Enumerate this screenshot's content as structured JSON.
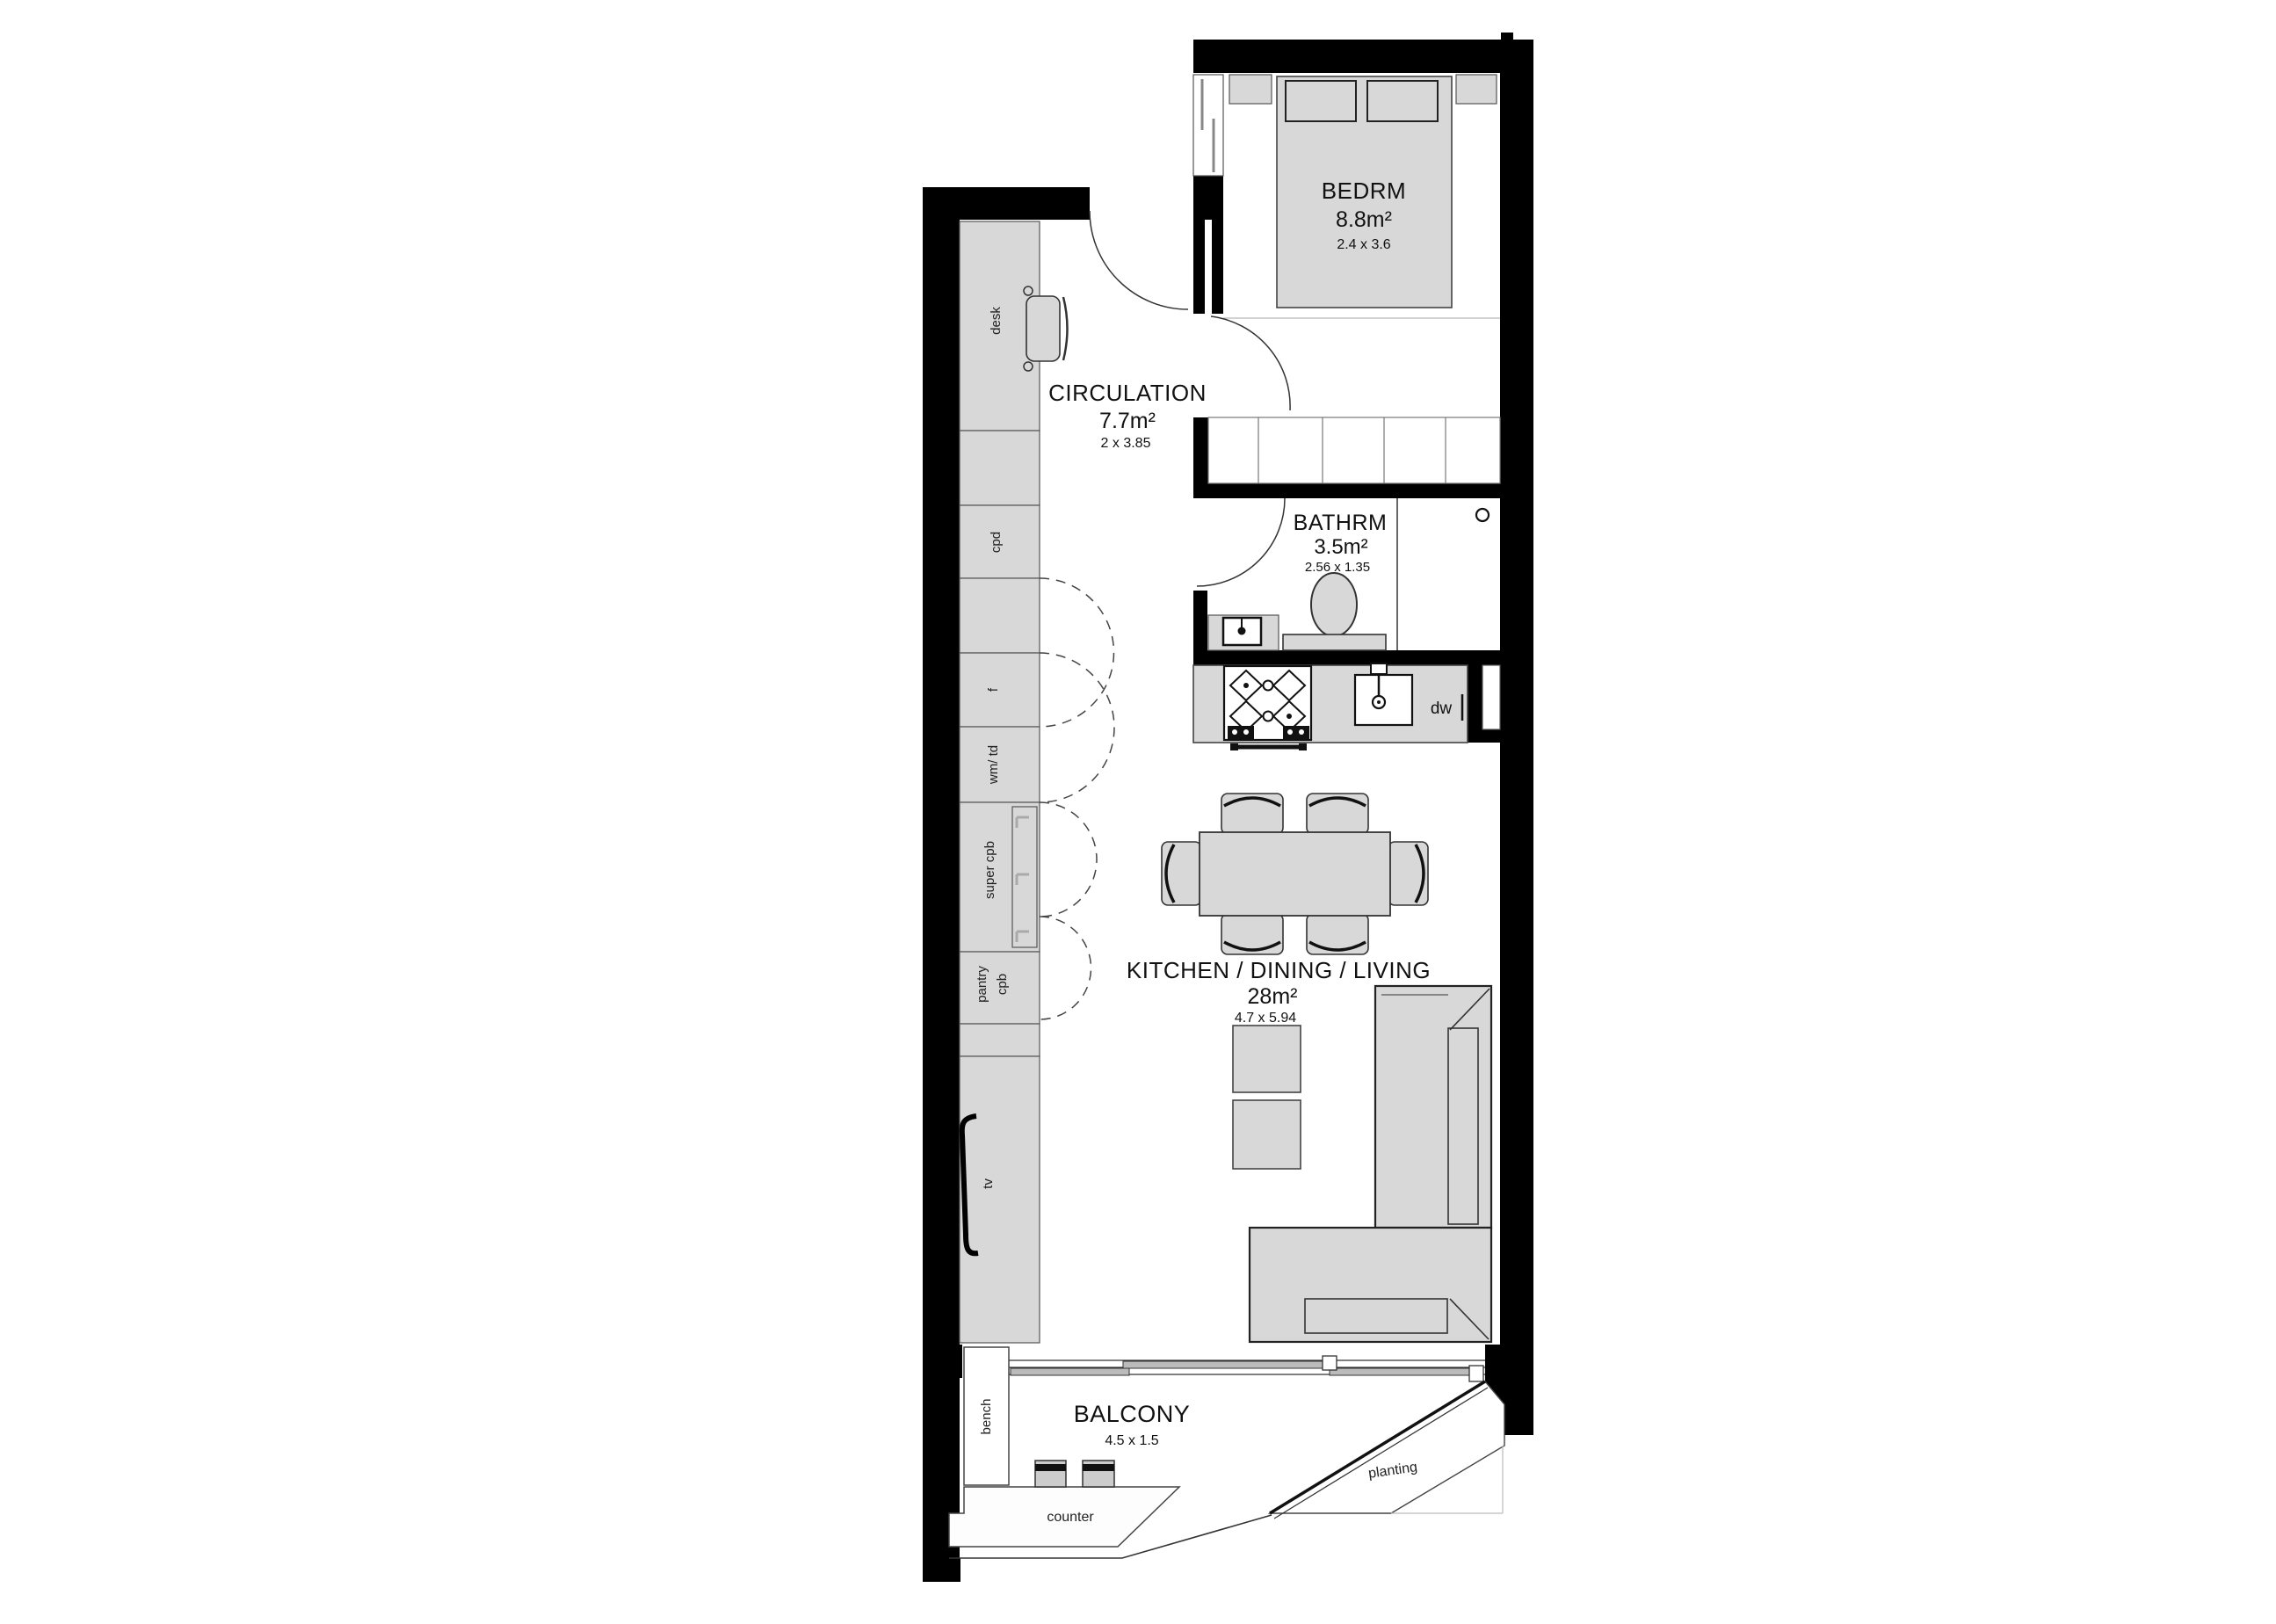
{
  "plan": {
    "type": "apartment-floor-plan",
    "rooms": {
      "bedroom": {
        "name": "BEDRM",
        "area": "8.8m²",
        "dims": "2.4 x 3.6"
      },
      "circulation": {
        "name": "CIRCULATION",
        "area": "7.7m²",
        "dims": "2 x 3.85"
      },
      "bathroom": {
        "name": "BATHRM",
        "area": "3.5m²",
        "dims": "2.56 x 1.35"
      },
      "living": {
        "name": "KITCHEN / DINING / LIVING",
        "area": "28m²",
        "dims": "4.7 x 5.94"
      },
      "balcony": {
        "name": "BALCONY",
        "dims": "4.5 x 1.5"
      }
    },
    "fixtures": {
      "desk": "desk",
      "cupboard": "cpd",
      "fridge": "f",
      "laundry": "wm/ td",
      "super_cupboard": "super cpb",
      "pantry_line1": "pantry",
      "pantry_line2": "cpb",
      "tv": "tv",
      "dishwasher": "dw",
      "bench": "bench",
      "counter": "counter",
      "planting": "planting"
    },
    "colors": {
      "wall": "#000000",
      "furniture": "#d8d8d8",
      "outline": "#333333",
      "background": "#ffffff"
    }
  }
}
